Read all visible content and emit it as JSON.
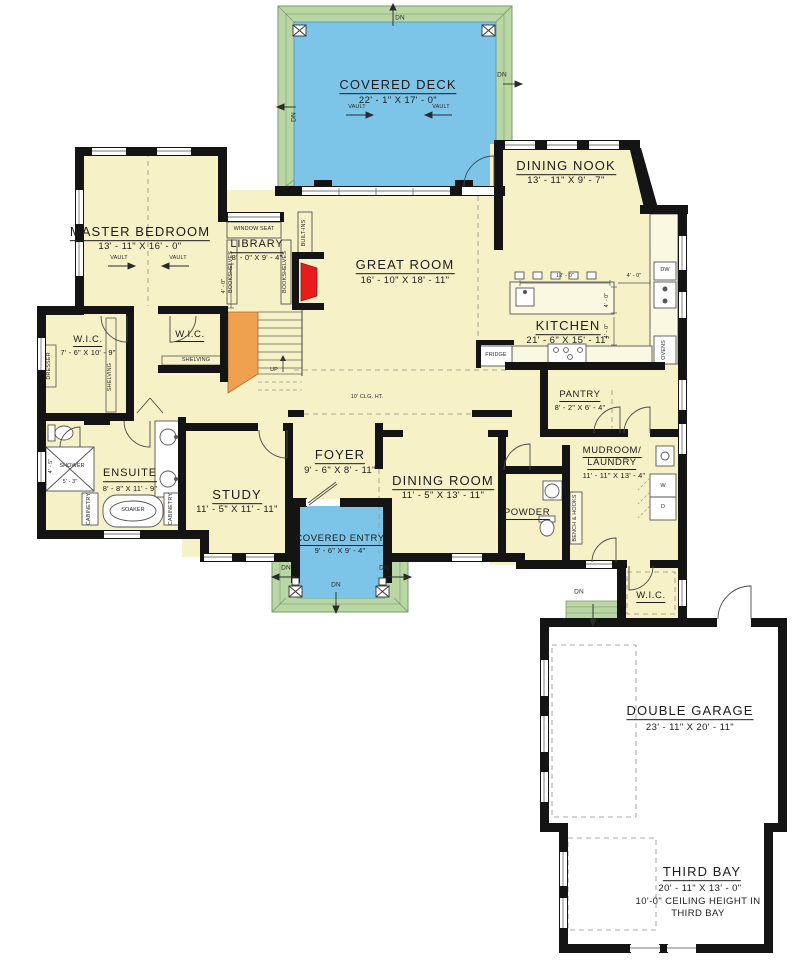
{
  "rooms": {
    "covered_deck": {
      "name": "COVERED DECK",
      "dims": "22' - 1\" X 17' - 0\""
    },
    "master_bedroom": {
      "name": "MASTER BEDROOM",
      "dims": "13' - 11\" X 16' - 0\""
    },
    "dining_nook": {
      "name": "DINING NOOK",
      "dims": "13' - 11\" X 9' - 7\""
    },
    "library": {
      "name": "LIBRARY",
      "dims": "8' - 0\" X 9' - 4\""
    },
    "great_room": {
      "name": "GREAT ROOM",
      "dims": "16' - 10\" X 18' - 11\""
    },
    "kitchen": {
      "name": "KITCHEN",
      "dims": "21' - 6\" X 15' - 11\""
    },
    "wic_master": {
      "name": "W.I.C.",
      "dims": "7' - 6\" X 10' - 9\""
    },
    "wic_hall": {
      "name": "W.I.C."
    },
    "wic_mud": {
      "name": "W.I.C."
    },
    "ensuite": {
      "name": "ENSUITE",
      "dims": "8' - 8\" X 11' - 9\""
    },
    "study": {
      "name": "STUDY",
      "dims": "11' - 5\" X 11' - 11\""
    },
    "foyer": {
      "name": "FOYER",
      "dims": "9' - 6\" X 8' - 11\""
    },
    "dining_room": {
      "name": "DINING ROOM",
      "dims": "11' - 5\" X 13' - 11\""
    },
    "covered_entry": {
      "name": "COVERED ENTRY",
      "dims": "9' - 6\" X 9' - 4\""
    },
    "powder": {
      "name": "POWDER"
    },
    "pantry": {
      "name": "PANTRY",
      "dims": "8' - 2\" X 6' - 4\""
    },
    "mudroom_laundry": {
      "name_line1": "MUDROOM/",
      "name_line2": "LAUNDRY",
      "dims": "11' - 11\" X 13' - 4\""
    },
    "double_garage": {
      "name": "DOUBLE GARAGE",
      "dims": "23' - 11\" X 20' - 11\""
    },
    "third_bay": {
      "name": "THIRD BAY",
      "dims": "20' - 11\" X 13' - 0\"",
      "note_line1": "10'-0\" CEILING HEIGHT IN",
      "note_line2": "THIRD BAY"
    }
  },
  "annotations": {
    "vault": "VAULT",
    "dn": "DN",
    "up": "UP",
    "window_seat": "WINDOW SEAT",
    "bookshelves": "BOOKSHELVES",
    "built_ins": "BUILT-INS",
    "shelving": "SHELVING",
    "dresser": "DRESSER",
    "cabinetry": "CABINETRY",
    "soaker": "SOAKER",
    "shower": "SHOWER",
    "shower_width": "4' - 5\"",
    "shower_length": "5' - 3\"",
    "fridge": "FRIDGE",
    "ovens": "OVENS",
    "dw": "DW",
    "bench_hooks": "BENCH & HOOKS",
    "washer": "W",
    "dryer": "D",
    "ceiling_height": "10' CLG. HT.",
    "island_length": "12' - 0\"",
    "four_feet": "4' - 0\""
  },
  "colors": {
    "floor": "#f6f1c6",
    "deck": "#7cc5e8",
    "porch": "#b8d7a4",
    "stairs": "#efa14f",
    "fireplace": "#e81c1c",
    "wall": "#141414"
  }
}
